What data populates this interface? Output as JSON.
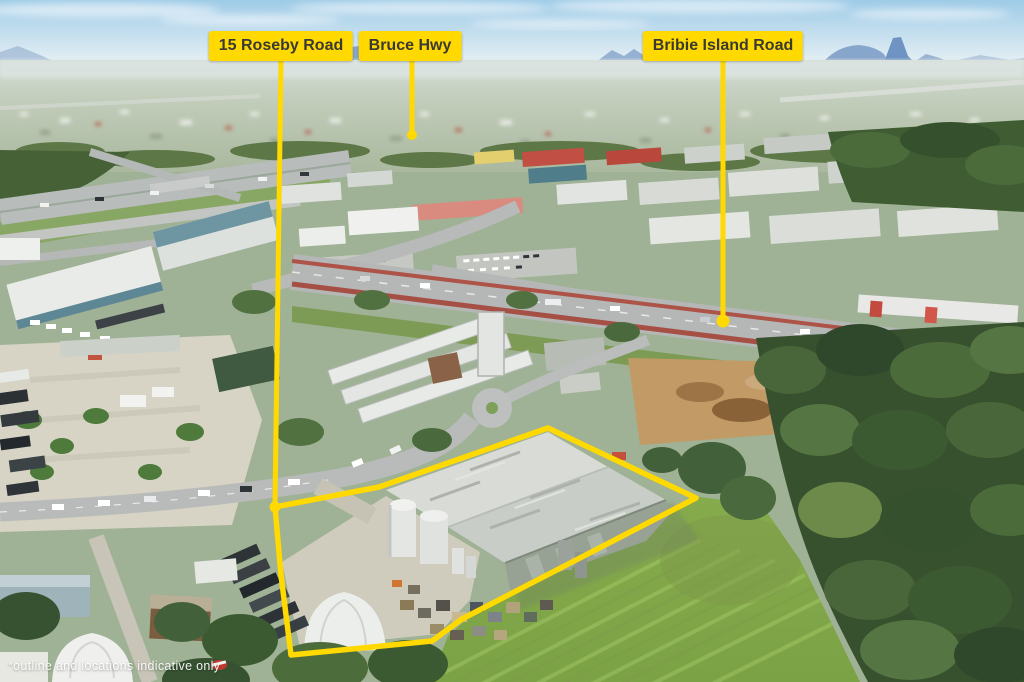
{
  "annotations": {
    "accent_color": "#FFD900",
    "label_text_color": "#3A3A33",
    "labels": [
      {
        "id": "roseby-road",
        "text": "15 Roseby Road"
      },
      {
        "id": "bruce-hwy",
        "text": "Bruce Hwy"
      },
      {
        "id": "bribie-island-road",
        "text": "Bribie Island Road"
      }
    ],
    "disclaimer": "*outline and locations indicative only"
  },
  "scene_palette": {
    "sky_top": "#9ECBE7",
    "sky_horizon": "#E8F1F5",
    "mountains": "#7E9EC7",
    "grass_field": "#8FB654",
    "forest": "#37512E",
    "road": "#B5B8B6",
    "red_lane_strip": "#AD5348",
    "warehouse_roof": "#D3D6D1",
    "dirt": "#C29A66"
  }
}
